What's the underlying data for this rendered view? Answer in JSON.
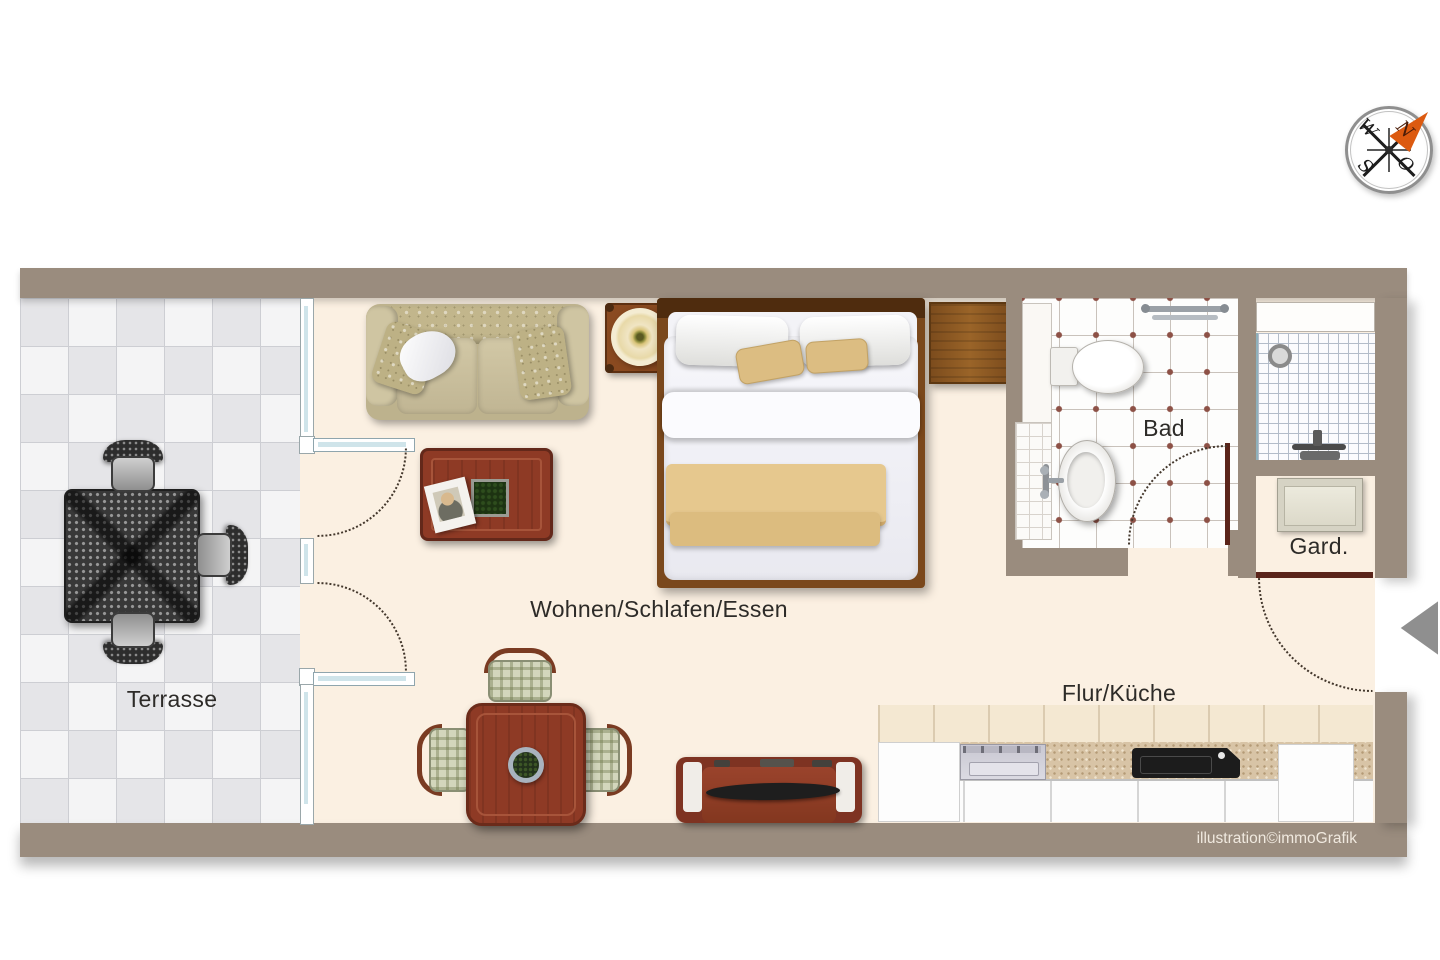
{
  "labels": {
    "terrace": "Terrasse",
    "living": "Wohnen/Schlafen/Essen",
    "bathroom": "Bad",
    "wardrobe": "Gard.",
    "hall_kitchen": "Flur/Küche"
  },
  "credit": "illustration©immoGrafik",
  "compass": {
    "west": "W",
    "north": "N",
    "south": "S",
    "east": "O"
  },
  "palette": {
    "wall": "#9a8c7e",
    "floor_cream": "#fbf0e2",
    "terrace_tile_light": "#f4f4f5",
    "terrace_tile_dark": "#e5e5e8",
    "window_glass": "#cfe4ea",
    "door_leaf_dark": "#5a241a",
    "bath_tile_dot": "#8d5146",
    "wood_red": "#8e3a25",
    "wood_brown": "#8a5a28",
    "bed_blanket_tan": "#e2c68d",
    "sofa_beige": "#c5ba97",
    "compass_arrow_orange": "#dc5a10",
    "entry_arrow_gray": "#8f8f8f",
    "label_color": "#2d2b28",
    "credit_color": "#f0e9df"
  }
}
